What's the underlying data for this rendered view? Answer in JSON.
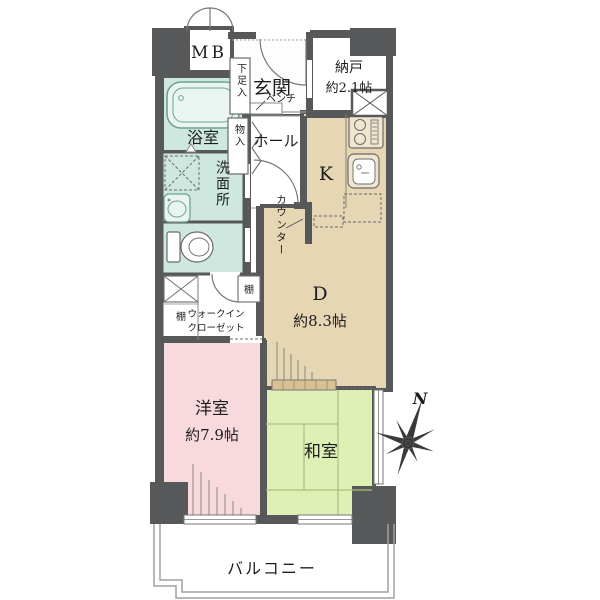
{
  "plan_title": "apartment-floor-plan",
  "rooms": {
    "mb": {
      "label": "MB"
    },
    "genkan": {
      "label": "玄関"
    },
    "shoe": {
      "label": "下足入"
    },
    "bench": {
      "label": "ベンチ"
    },
    "nando": {
      "label": "納戸",
      "size": "約2.1帖"
    },
    "bath": {
      "label": "浴室"
    },
    "monoire": {
      "label": "物入"
    },
    "hall": {
      "label": "ホール"
    },
    "kitchen": {
      "label": "K"
    },
    "counter": {
      "label": "カウンター"
    },
    "washroom": {
      "label": "洗面所"
    },
    "dining": {
      "label": "D",
      "size": "約8.3帖"
    },
    "shelf_left": {
      "label": "棚"
    },
    "shelf_right": {
      "label": "棚"
    },
    "wic": {
      "line1": "ウォークイン",
      "line2": "クローゼット"
    },
    "western": {
      "label": "洋室",
      "size": "約7.9帖"
    },
    "washitsu": {
      "label": "和室"
    },
    "balcony": {
      "label": "バルコニー"
    }
  },
  "compass": {
    "label": "N"
  },
  "colors": {
    "wall": "#57585a",
    "wet_room": "#cfe8df",
    "dk_floor": "#e6d6b4",
    "western_room": "#f8dade",
    "tatami": "#dff0b4",
    "fusuma": "#d8c193",
    "balcony_line": "#a0a0a0"
  }
}
